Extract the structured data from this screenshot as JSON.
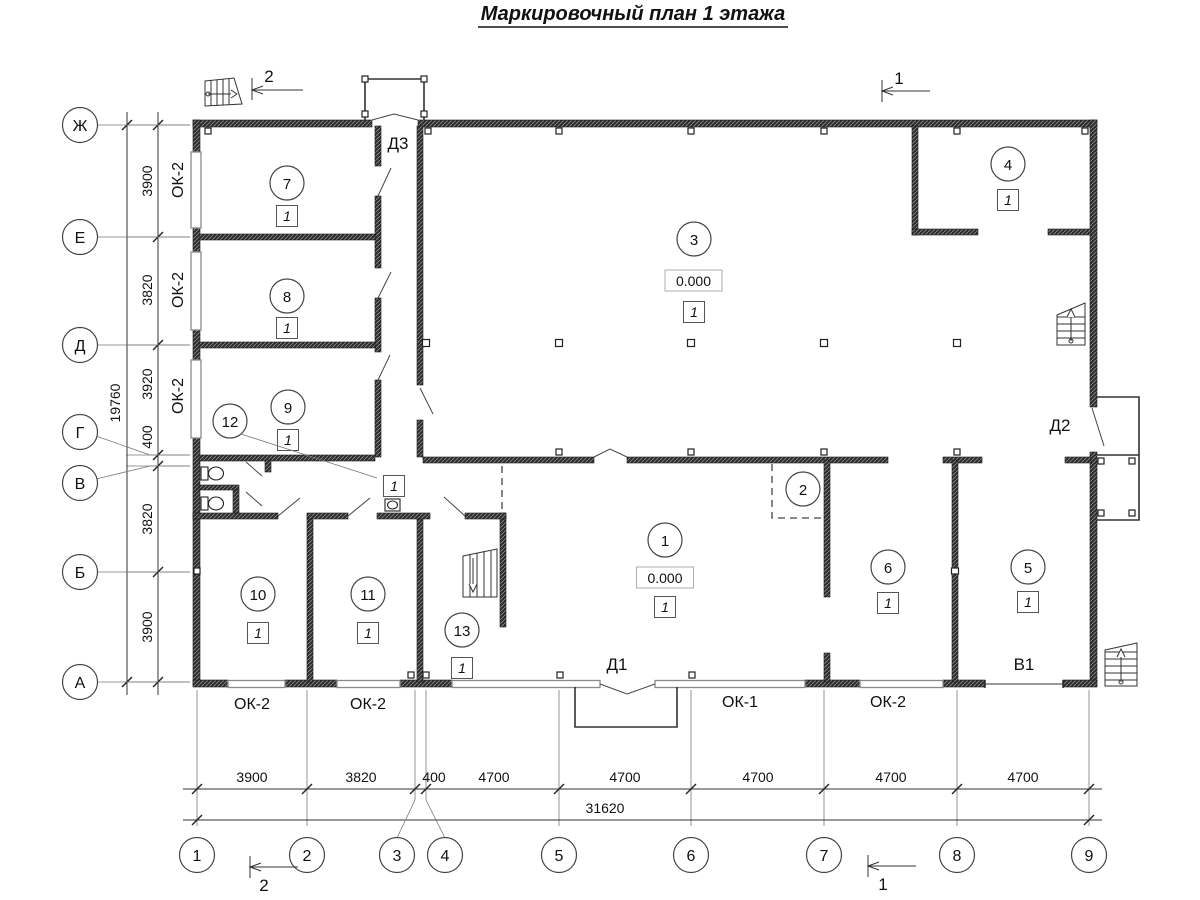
{
  "title": "Маркировочный план 1 этажа",
  "grid": {
    "rows": [
      "Ж",
      "Е",
      "Д",
      "Г",
      "В",
      "Б",
      "А"
    ],
    "cols": [
      "1",
      "2",
      "3",
      "4",
      "5",
      "6",
      "7",
      "8",
      "9"
    ]
  },
  "dimensions": {
    "vertical": [
      "3900",
      "3820",
      "3920",
      "400",
      "3820",
      "3900"
    ],
    "vertical_total": "19760",
    "horizontal": [
      "3900",
      "3820",
      "400",
      "4700",
      "4700",
      "4700",
      "4700",
      "4700"
    ],
    "horizontal_total": "31620"
  },
  "rooms": {
    "r1": {
      "number": "1",
      "tag": "1",
      "elevation": "0.000"
    },
    "r2": {
      "number": "2"
    },
    "r3": {
      "number": "3",
      "tag": "1",
      "elevation": "0.000"
    },
    "r4": {
      "number": "4",
      "tag": "1"
    },
    "r5": {
      "number": "5",
      "tag": "1"
    },
    "r6": {
      "number": "6",
      "tag": "1"
    },
    "r7": {
      "number": "7",
      "tag": "1"
    },
    "r8": {
      "number": "8",
      "tag": "1"
    },
    "r9": {
      "number": "9",
      "tag": "1"
    },
    "r10": {
      "number": "10",
      "tag": "1"
    },
    "r11": {
      "number": "11",
      "tag": "1"
    },
    "r12": {
      "number": "12",
      "tag": "1"
    },
    "r13": {
      "number": "13",
      "tag": "1"
    }
  },
  "windows": {
    "ok1": "ОК-1",
    "ok2": "ОК-2"
  },
  "doors": {
    "d1": "Д1",
    "d2": "Д2",
    "d3": "Д3",
    "v1": "В1"
  },
  "sections": {
    "s1": "1",
    "s2": "2"
  }
}
